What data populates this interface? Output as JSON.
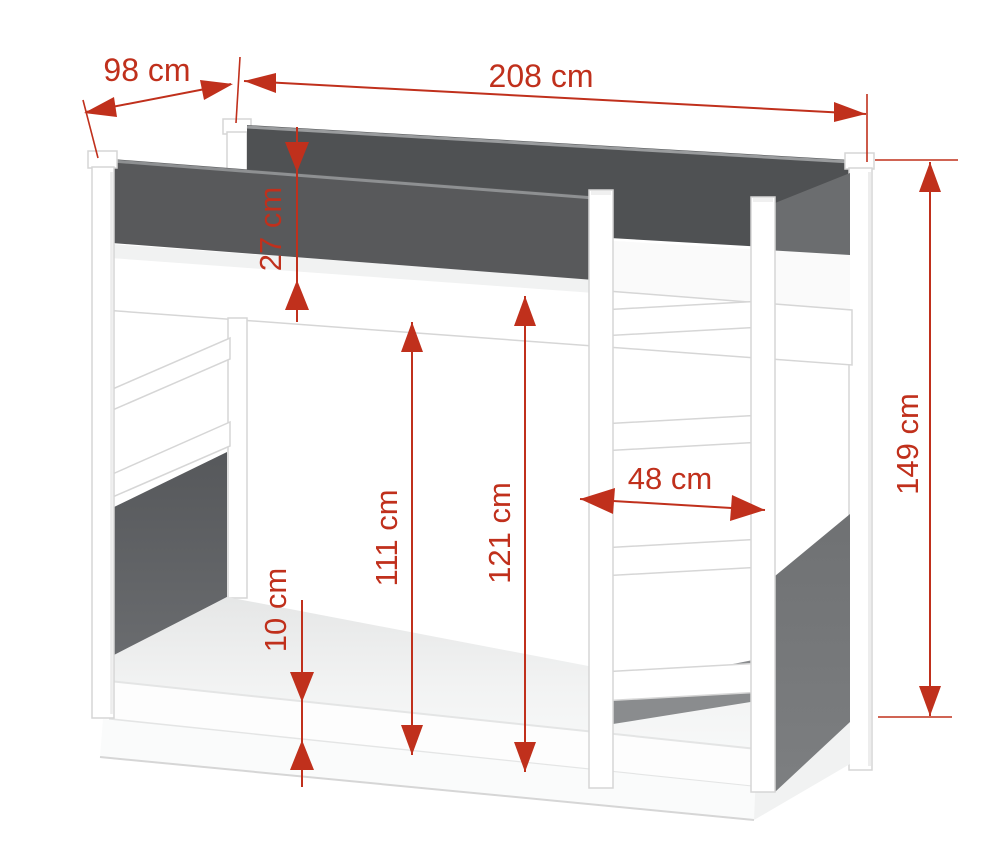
{
  "diagram": {
    "subject": "bunk bed dimension drawing",
    "unit": "cm",
    "dims": {
      "depth": "98 cm",
      "width": "208 cm",
      "rail_height": "27 cm",
      "under_clearance": "111 cm",
      "opening_height": "121 cm",
      "base_height": "10 cm",
      "ladder_width": "48 cm",
      "total_height": "149 cm"
    },
    "colors": {
      "dimension_red": "#c0301c",
      "front_rail_gray": "#58595b",
      "back_rail_gray": "#4f5153",
      "side_panel_upper_gray": "#6b6d6f",
      "side_panel_lower_left_gray": "#5d5f62",
      "side_panel_lower_right_gray": "#747678",
      "frame_white": "#ffffff",
      "background": "#ffffff"
    }
  }
}
